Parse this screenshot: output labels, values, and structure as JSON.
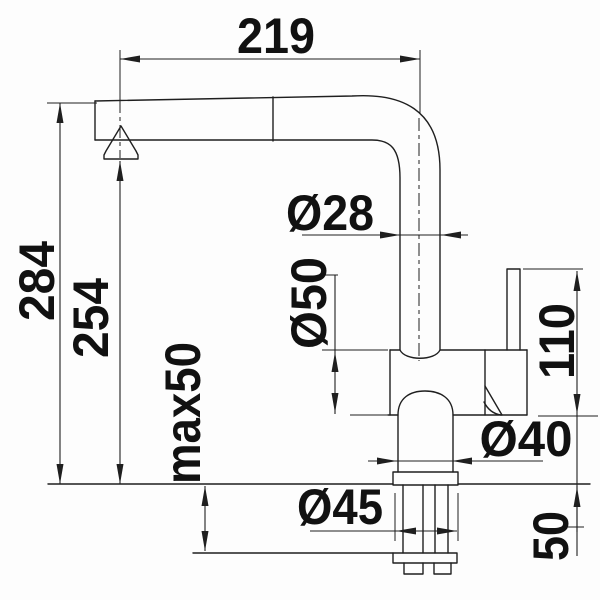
{
  "drawing": {
    "type": "faucet-installation-dimension-drawing",
    "units_implied": "mm",
    "line_color": "#1f1f1f",
    "background": "#fdfdfd",
    "dimensions": {
      "spout_reach": "219",
      "height_overall": "284",
      "height_spout_outlet": "254",
      "max_counter_thickness": "max50",
      "spout_pipe_diameter": "Ø28",
      "body_diameter": "Ø50",
      "lever_height": "110",
      "base_diameter": "Ø40",
      "flange_diameter": "Ø45",
      "shank_length": "50"
    }
  }
}
